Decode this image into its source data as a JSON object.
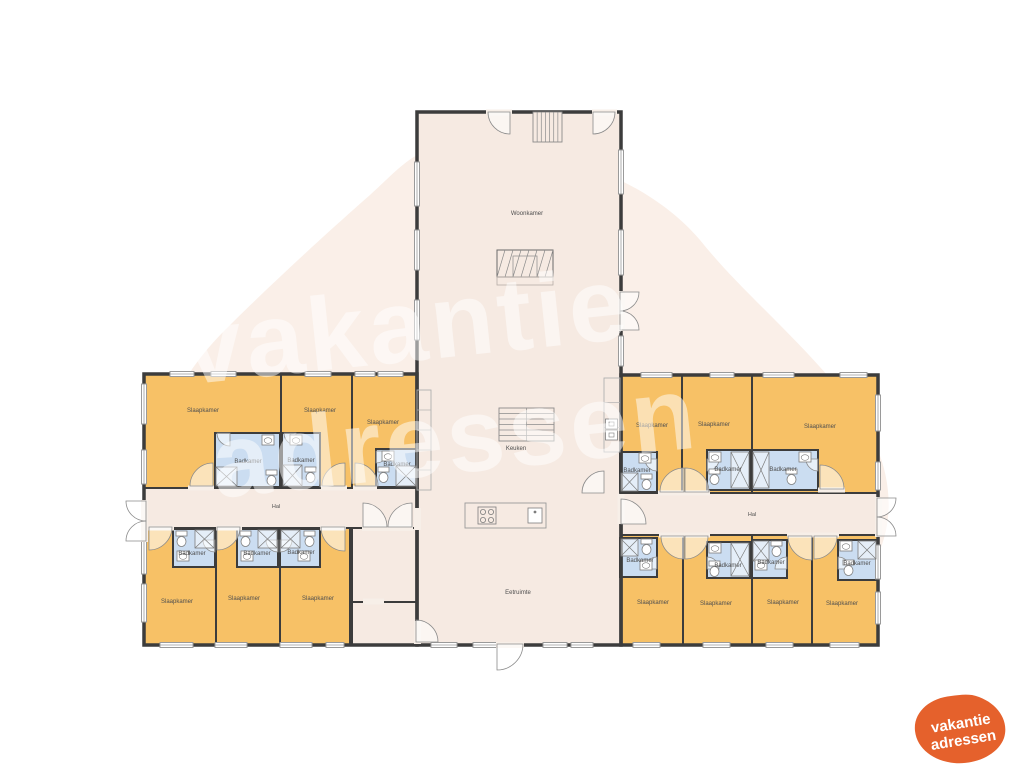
{
  "palette": {
    "wall": "#3c3c3c",
    "bedroom": "#F7C166",
    "bathroom": "#CBDDF1",
    "common": "#F6EAE2",
    "blob": "#FAEFE8",
    "fixture": "#7d7d7d",
    "label": "#4f4f4f",
    "window_frame": "#9a9a9a",
    "door": "#8b8b8b",
    "gap": "#F7EFE8",
    "logo_orange": "#E5612C",
    "watermark": "rgba(255,255,255,0.5)"
  },
  "watermark": {
    "line1": "vakantie",
    "line2": "adressen"
  },
  "logo": {
    "line1": "vakantie",
    "line2": "adressen"
  },
  "room_labels": {
    "bedroom": "Slaapkamer",
    "bathroom": "Badkamer",
    "hall": "Hal",
    "living": "Woonkamer",
    "kitchen": "Keuken",
    "dining": "Eetruimte"
  },
  "floorplan": {
    "outlines": [
      [
        144,
        374,
        273,
        271
      ],
      [
        621,
        375,
        257,
        270
      ],
      [
        417,
        112,
        204,
        533
      ]
    ],
    "rooms": [
      {
        "name": "central-living-area",
        "type": "common",
        "x": 417,
        "y": 112,
        "w": 204,
        "h": 533,
        "labelKey": null
      },
      {
        "name": "hall-left",
        "type": "common",
        "x": 144,
        "y": 488,
        "w": 273,
        "h": 40,
        "labelKey": null
      },
      {
        "name": "hall-right",
        "type": "common",
        "x": 621,
        "y": 493,
        "w": 257,
        "h": 42,
        "labelKey": null
      },
      {
        "name": "storage-1",
        "type": "common",
        "x": 352,
        "y": 528,
        "w": 65,
        "h": 74,
        "labelKey": null
      },
      {
        "name": "storage-2",
        "type": "common",
        "x": 352,
        "y": 602,
        "w": 65,
        "h": 43,
        "labelKey": null
      },
      {
        "name": "bedroom-1",
        "type": "bedroom",
        "x": 144,
        "y": 374,
        "w": 137,
        "h": 114,
        "labelKey": "bedroom",
        "lx": 203,
        "ly": 412
      },
      {
        "name": "bedroom-2",
        "type": "bedroom",
        "x": 281,
        "y": 374,
        "w": 71,
        "h": 114,
        "labelKey": "bedroom",
        "lx": 320,
        "ly": 412
      },
      {
        "name": "bedroom-3",
        "type": "bedroom",
        "x": 352,
        "y": 374,
        "w": 65,
        "h": 114,
        "labelKey": "bedroom",
        "lx": 383,
        "ly": 424
      },
      {
        "name": "bedroom-4",
        "type": "bedroom",
        "x": 144,
        "y": 528,
        "w": 72,
        "h": 117,
        "labelKey": "bedroom",
        "lx": 177,
        "ly": 603
      },
      {
        "name": "bedroom-5",
        "type": "bedroom",
        "x": 216,
        "y": 528,
        "w": 64,
        "h": 117,
        "labelKey": "bedroom",
        "lx": 244,
        "ly": 600
      },
      {
        "name": "bedroom-6",
        "type": "bedroom",
        "x": 280,
        "y": 528,
        "w": 70,
        "h": 117,
        "labelKey": "bedroom",
        "lx": 318,
        "ly": 600
      },
      {
        "name": "bedroom-7",
        "type": "bedroom",
        "x": 621,
        "y": 375,
        "w": 61,
        "h": 118,
        "labelKey": "bedroom",
        "lx": 652,
        "ly": 427
      },
      {
        "name": "bedroom-8",
        "type": "bedroom",
        "x": 682,
        "y": 375,
        "w": 70,
        "h": 118,
        "labelKey": "bedroom",
        "lx": 714,
        "ly": 426
      },
      {
        "name": "bedroom-9",
        "type": "bedroom",
        "x": 752,
        "y": 375,
        "w": 126,
        "h": 118,
        "labelKey": "bedroom",
        "lx": 820,
        "ly": 428
      },
      {
        "name": "bedroom-10",
        "type": "bedroom",
        "x": 621,
        "y": 535,
        "w": 62,
        "h": 110,
        "labelKey": "bedroom",
        "lx": 653,
        "ly": 604
      },
      {
        "name": "bedroom-11",
        "type": "bedroom",
        "x": 683,
        "y": 535,
        "w": 69,
        "h": 110,
        "labelKey": "bedroom",
        "lx": 716,
        "ly": 605
      },
      {
        "name": "bedroom-12",
        "type": "bedroom",
        "x": 752,
        "y": 535,
        "w": 60,
        "h": 110,
        "labelKey": "bedroom",
        "lx": 783,
        "ly": 604
      },
      {
        "name": "bedroom-13",
        "type": "bedroom",
        "x": 812,
        "y": 535,
        "w": 66,
        "h": 110,
        "labelKey": "bedroom",
        "lx": 842,
        "ly": 605
      },
      {
        "name": "bathroom-1",
        "type": "bathroom",
        "x": 215,
        "y": 433,
        "w": 65,
        "h": 54,
        "labelKey": "bathroom",
        "lx": 248,
        "ly": 463
      },
      {
        "name": "bathroom-2",
        "type": "bathroom",
        "x": 282,
        "y": 433,
        "w": 38,
        "h": 54,
        "labelKey": "bathroom",
        "lx": 301,
        "ly": 462
      },
      {
        "name": "bathroom-3",
        "type": "bathroom",
        "x": 376,
        "y": 449,
        "w": 41,
        "h": 38,
        "labelKey": "bathroom",
        "lx": 397,
        "ly": 466
      },
      {
        "name": "bathroom-4",
        "type": "bathroom",
        "x": 173,
        "y": 529,
        "w": 42,
        "h": 38,
        "labelKey": "bathroom",
        "lx": 192,
        "ly": 555
      },
      {
        "name": "bathroom-5",
        "type": "bathroom",
        "x": 237,
        "y": 529,
        "w": 41,
        "h": 38,
        "labelKey": "bathroom",
        "lx": 257,
        "ly": 555
      },
      {
        "name": "bathroom-6",
        "type": "bathroom",
        "x": 280,
        "y": 529,
        "w": 40,
        "h": 38,
        "labelKey": "bathroom",
        "lx": 301,
        "ly": 554
      },
      {
        "name": "bathroom-7",
        "type": "bathroom",
        "x": 620,
        "y": 452,
        "w": 37,
        "h": 40,
        "labelKey": "bathroom",
        "lx": 637,
        "ly": 472
      },
      {
        "name": "bathroom-8",
        "type": "bathroom",
        "x": 707,
        "y": 450,
        "w": 43,
        "h": 40,
        "labelKey": "bathroom",
        "lx": 728,
        "ly": 471
      },
      {
        "name": "bathroom-9",
        "type": "bathroom",
        "x": 752,
        "y": 450,
        "w": 66,
        "h": 40,
        "labelKey": "bathroom",
        "lx": 783,
        "ly": 471
      },
      {
        "name": "bathroom-10",
        "type": "bathroom",
        "x": 620,
        "y": 538,
        "w": 37,
        "h": 39,
        "labelKey": "bathroom",
        "lx": 640,
        "ly": 562
      },
      {
        "name": "bathroom-11",
        "type": "bathroom",
        "x": 707,
        "y": 542,
        "w": 43,
        "h": 36,
        "labelKey": "bathroom",
        "lx": 728,
        "ly": 567
      },
      {
        "name": "bathroom-12",
        "type": "bathroom",
        "x": 752,
        "y": 540,
        "w": 35,
        "h": 38,
        "labelKey": "bathroom",
        "lx": 771,
        "ly": 564
      },
      {
        "name": "bathroom-13",
        "type": "bathroom",
        "x": 838,
        "y": 540,
        "w": 39,
        "h": 40,
        "labelKey": "bathroom",
        "lx": 857,
        "ly": 565
      }
    ],
    "free_labels": [
      {
        "key": "living",
        "x": 527,
        "y": 215,
        "size": 6
      },
      {
        "key": "kitchen",
        "x": 516,
        "y": 450,
        "size": 6
      },
      {
        "key": "dining",
        "x": 518,
        "y": 594,
        "size": 6
      },
      {
        "key": "hall",
        "x": 276,
        "y": 508,
        "size": 5.5
      },
      {
        "key": "hall",
        "x": 752,
        "y": 516,
        "size": 5.5
      }
    ],
    "windows": [
      [
        170,
        371.5,
        24,
        5
      ],
      [
        211,
        371.5,
        25,
        5
      ],
      [
        305,
        371.5,
        26,
        5
      ],
      [
        355,
        371.5,
        20,
        5
      ],
      [
        378,
        371.5,
        25,
        5
      ],
      [
        141.5,
        384,
        5,
        40
      ],
      [
        141.5,
        450,
        5,
        34
      ],
      [
        141.5,
        540,
        5,
        34
      ],
      [
        141.5,
        584,
        5,
        38
      ],
      [
        160,
        642.5,
        33,
        5
      ],
      [
        215,
        642.5,
        32,
        5
      ],
      [
        280,
        642.5,
        32,
        5
      ],
      [
        326,
        642.5,
        18,
        5
      ],
      [
        414.5,
        162,
        5,
        44
      ],
      [
        414.5,
        230,
        5,
        40
      ],
      [
        414.5,
        300,
        5,
        40
      ],
      [
        618.5,
        150,
        5,
        44
      ],
      [
        618.5,
        230,
        5,
        45
      ],
      [
        618.5,
        336,
        5,
        30
      ],
      [
        431,
        642.5,
        26,
        5
      ],
      [
        473,
        642.5,
        24,
        5
      ],
      [
        543,
        642.5,
        24,
        5
      ],
      [
        571,
        642.5,
        22,
        5
      ],
      [
        641,
        372.5,
        31,
        5
      ],
      [
        710,
        372.5,
        24,
        5
      ],
      [
        763,
        372.5,
        31,
        5
      ],
      [
        840,
        372.5,
        27,
        5
      ],
      [
        875.5,
        395,
        5,
        36
      ],
      [
        875.5,
        462,
        5,
        28
      ],
      [
        875.5,
        545,
        5,
        34
      ],
      [
        875.5,
        592,
        5,
        32
      ],
      [
        633,
        642.5,
        27,
        5
      ],
      [
        703,
        642.5,
        27,
        5
      ],
      [
        766,
        642.5,
        27,
        5
      ],
      [
        830,
        642.5,
        29,
        5
      ]
    ],
    "door_gaps": [
      [
        141,
        500,
        7,
        42
      ],
      [
        875,
        497,
        7,
        40
      ],
      [
        618,
        291,
        7,
        40
      ],
      [
        486,
        109.5,
        26,
        6
      ],
      [
        592,
        109.5,
        25,
        6
      ],
      [
        496,
        642,
        28,
        6
      ],
      [
        414,
        508,
        7,
        22
      ],
      [
        362,
        525,
        51,
        6
      ],
      [
        617.5,
        494,
        7,
        30
      ],
      [
        363,
        598.5,
        21,
        6
      ],
      [
        414,
        621,
        7,
        23
      ],
      [
        188,
        485.5,
        26,
        5
      ],
      [
        321,
        485.5,
        26,
        5
      ],
      [
        353,
        485.5,
        24,
        5
      ],
      [
        148,
        525.5,
        26,
        5
      ],
      [
        216,
        525.5,
        26,
        5
      ],
      [
        320,
        525.5,
        26,
        5
      ],
      [
        658,
        490.5,
        27,
        5
      ],
      [
        684,
        490.5,
        26,
        5
      ],
      [
        818,
        487.5,
        27,
        5
      ],
      [
        659,
        532.5,
        26,
        5
      ],
      [
        684,
        532.5,
        26,
        5
      ],
      [
        787,
        532.5,
        26,
        5
      ],
      [
        813,
        532.5,
        26,
        5
      ]
    ],
    "doors": [
      [
        213,
        486,
        23,
        180,
        270
      ],
      [
        345,
        486,
        23,
        180,
        270
      ],
      [
        355,
        486,
        23,
        270,
        360
      ],
      [
        149,
        527,
        23,
        0,
        90
      ],
      [
        217,
        527,
        23,
        0,
        90
      ],
      [
        345,
        527,
        24,
        90,
        180
      ],
      [
        684,
        492,
        24,
        180,
        270
      ],
      [
        685,
        492,
        24,
        270,
        360
      ],
      [
        820,
        489,
        24,
        270,
        360
      ],
      [
        684,
        536,
        23,
        90,
        180
      ],
      [
        685,
        536,
        23,
        0,
        90
      ],
      [
        812,
        536,
        24,
        90,
        180
      ],
      [
        814,
        536,
        23,
        0,
        90
      ],
      [
        146,
        501,
        20,
        90,
        180
      ],
      [
        146,
        541,
        20,
        180,
        270
      ],
      [
        877,
        498,
        19,
        0,
        90
      ],
      [
        877,
        536,
        19,
        270,
        360
      ],
      [
        620,
        292,
        19,
        0,
        90
      ],
      [
        620,
        330,
        19,
        270,
        360
      ],
      [
        510,
        112,
        22,
        90,
        180
      ],
      [
        593,
        112,
        22,
        0,
        90
      ],
      [
        497,
        644,
        26,
        0,
        90
      ],
      [
        604,
        493,
        22,
        180,
        270
      ],
      [
        621,
        524,
        25,
        270,
        360
      ],
      [
        363,
        527,
        24,
        270,
        360
      ],
      [
        412,
        527,
        24,
        180,
        270
      ],
      [
        416,
        642,
        22,
        270,
        360
      ],
      [
        230,
        433,
        13,
        90,
        180
      ],
      [
        296,
        433,
        12,
        90,
        180
      ],
      [
        376,
        451,
        12,
        0,
        90
      ],
      [
        215,
        540,
        12,
        90,
        180
      ],
      [
        278,
        540,
        12,
        90,
        180
      ],
      [
        280,
        540,
        12,
        0,
        90
      ],
      [
        657,
        459,
        12,
        90,
        180
      ],
      [
        707,
        459,
        12,
        0,
        90
      ],
      [
        818,
        459,
        12,
        90,
        180
      ],
      [
        657,
        569,
        12,
        180,
        270
      ],
      [
        707,
        569,
        12,
        270,
        360
      ],
      [
        787,
        569,
        12,
        180,
        270
      ],
      [
        838,
        569,
        12,
        270,
        360
      ]
    ],
    "stairs": [
      {
        "x": 533,
        "y": 112,
        "w": 29,
        "h": 30,
        "dir": "v",
        "steps": 7
      },
      {
        "x": 499,
        "y": 408,
        "w": 55,
        "h": 33,
        "dir": "h",
        "steps": 6
      }
    ],
    "fireplace": {
      "x": 497,
      "y": 250,
      "w": 56,
      "h": 27,
      "base_h": 8
    },
    "island": {
      "x": 465,
      "y": 503,
      "w": 81,
      "h": 25
    },
    "counters": [
      {
        "x": 417,
        "y": 390,
        "w": 14,
        "h": 100,
        "n": 4
      },
      {
        "x": 604,
        "y": 378,
        "w": 16,
        "h": 74,
        "n": 2
      }
    ],
    "appliances": [
      [
        605.5,
        419,
        12,
        10
      ],
      [
        605.5,
        430,
        12,
        10
      ]
    ],
    "fixtures": {
      "showers": [
        [
          216,
          467,
          21,
          19
        ],
        [
          283,
          465,
          19,
          21
        ],
        [
          396,
          466,
          20,
          20
        ],
        [
          195,
          530,
          19,
          18
        ],
        [
          258,
          530,
          19,
          18
        ],
        [
          281,
          530,
          19,
          18
        ],
        [
          621,
          473,
          17,
          18
        ],
        [
          731,
          452,
          18,
          36
        ],
        [
          753,
          452,
          16,
          36
        ],
        [
          621,
          539,
          17,
          17
        ],
        [
          731,
          543,
          18,
          33
        ],
        [
          753,
          541,
          16,
          20
        ],
        [
          858,
          541,
          18,
          18
        ]
      ],
      "toilets": [
        [
          266,
          470
        ],
        [
          305,
          467
        ],
        [
          378,
          467
        ],
        [
          176,
          531
        ],
        [
          240,
          531
        ],
        [
          304,
          531
        ],
        [
          641,
          474
        ],
        [
          709,
          469
        ],
        [
          786,
          469
        ],
        [
          641,
          539
        ],
        [
          709,
          561
        ],
        [
          771,
          541
        ],
        [
          843,
          560
        ]
      ],
      "sinks": [
        [
          262,
          435
        ],
        [
          290,
          435
        ],
        [
          382,
          451
        ],
        [
          177,
          551
        ],
        [
          241,
          551
        ],
        [
          298,
          551
        ],
        [
          639,
          453
        ],
        [
          709,
          452
        ],
        [
          799,
          452
        ],
        [
          640,
          560
        ],
        [
          709,
          543
        ],
        [
          755,
          560
        ],
        [
          840,
          541
        ]
      ]
    }
  }
}
